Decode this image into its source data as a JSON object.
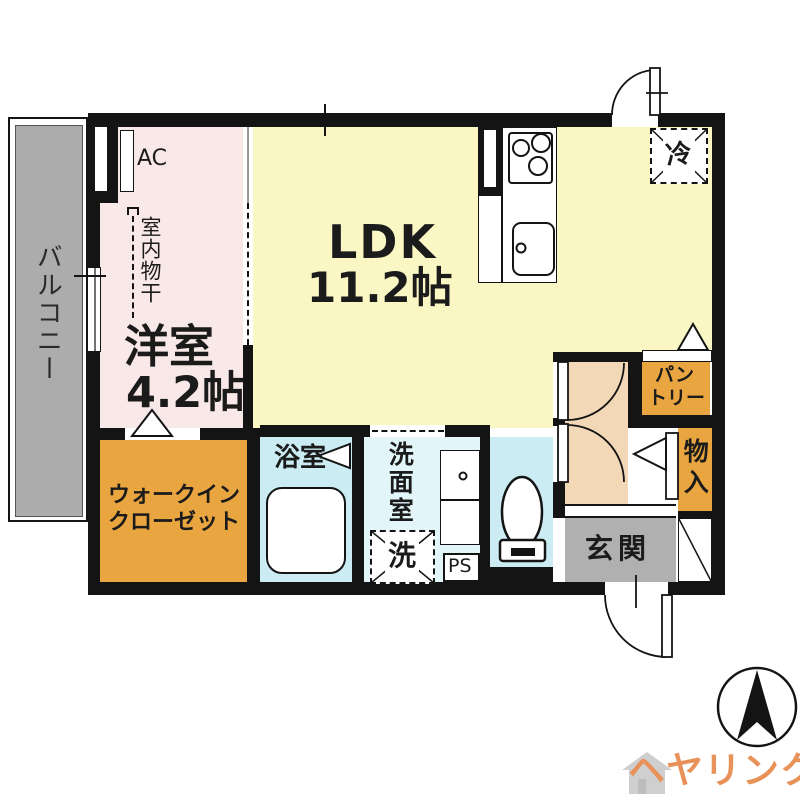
{
  "floorplan": {
    "rooms": {
      "ldk": {
        "name": "LDK",
        "size": "11.2帖"
      },
      "bedroom": {
        "name": "洋室",
        "size": "4.2帖"
      },
      "balcony": {
        "name": "バルコニー"
      },
      "wic": {
        "line1": "ウォークイン",
        "line2": "クローゼット"
      },
      "bathroom": {
        "name": "浴室"
      },
      "washroom": {
        "name": "洗面室"
      },
      "toilet": {
        "name": ""
      },
      "entrance": {
        "name": "玄関"
      },
      "pantry": {
        "line1": "パン",
        "line2": "トリー"
      },
      "storage": {
        "name": "物入"
      }
    },
    "fixtures": {
      "ac": "AC",
      "indoor_drying": "室内物干",
      "refrigerator": "冷",
      "washer": "洗",
      "pipe_space": "PS"
    },
    "colors": {
      "wall": "#141414",
      "ldk_yellow": "#FAF7C4",
      "bedroom_pink": "#F8E8E7",
      "hall_beige": "#F3D8B8",
      "closet_orange": "#E9A53F",
      "wet_cyan": "#CBECF2",
      "washroom_cyan": "#E2F5F8",
      "entrance_gray": "#B0B0B0",
      "balcony_gray": "#ACACAC"
    }
  },
  "branding": {
    "logo_text": "ヘヤリンク",
    "logo_color": "#E8925A"
  }
}
